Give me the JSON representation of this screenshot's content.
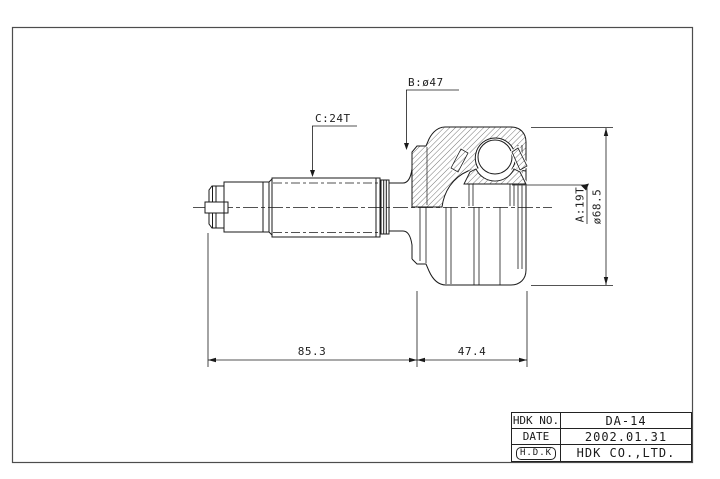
{
  "drawing": {
    "labels": {
      "spline_b": "B:ø47",
      "spline_c": "C:24T",
      "spline_a": "A:19T",
      "outer_diameter": "ø68.5",
      "length_shaft": "85.3",
      "length_joint": "47.4"
    },
    "colors": {
      "line": "#1a1a1a",
      "frame": "#4d4d4d",
      "background": "#ffffff"
    }
  },
  "title_block": {
    "rows": [
      {
        "label": "HDK NO.",
        "value": "DA-14"
      },
      {
        "label": "DATE",
        "value": "2002.01.31"
      },
      {
        "label": "H.D.K",
        "value": "HDK CO.,LTD."
      }
    ]
  }
}
